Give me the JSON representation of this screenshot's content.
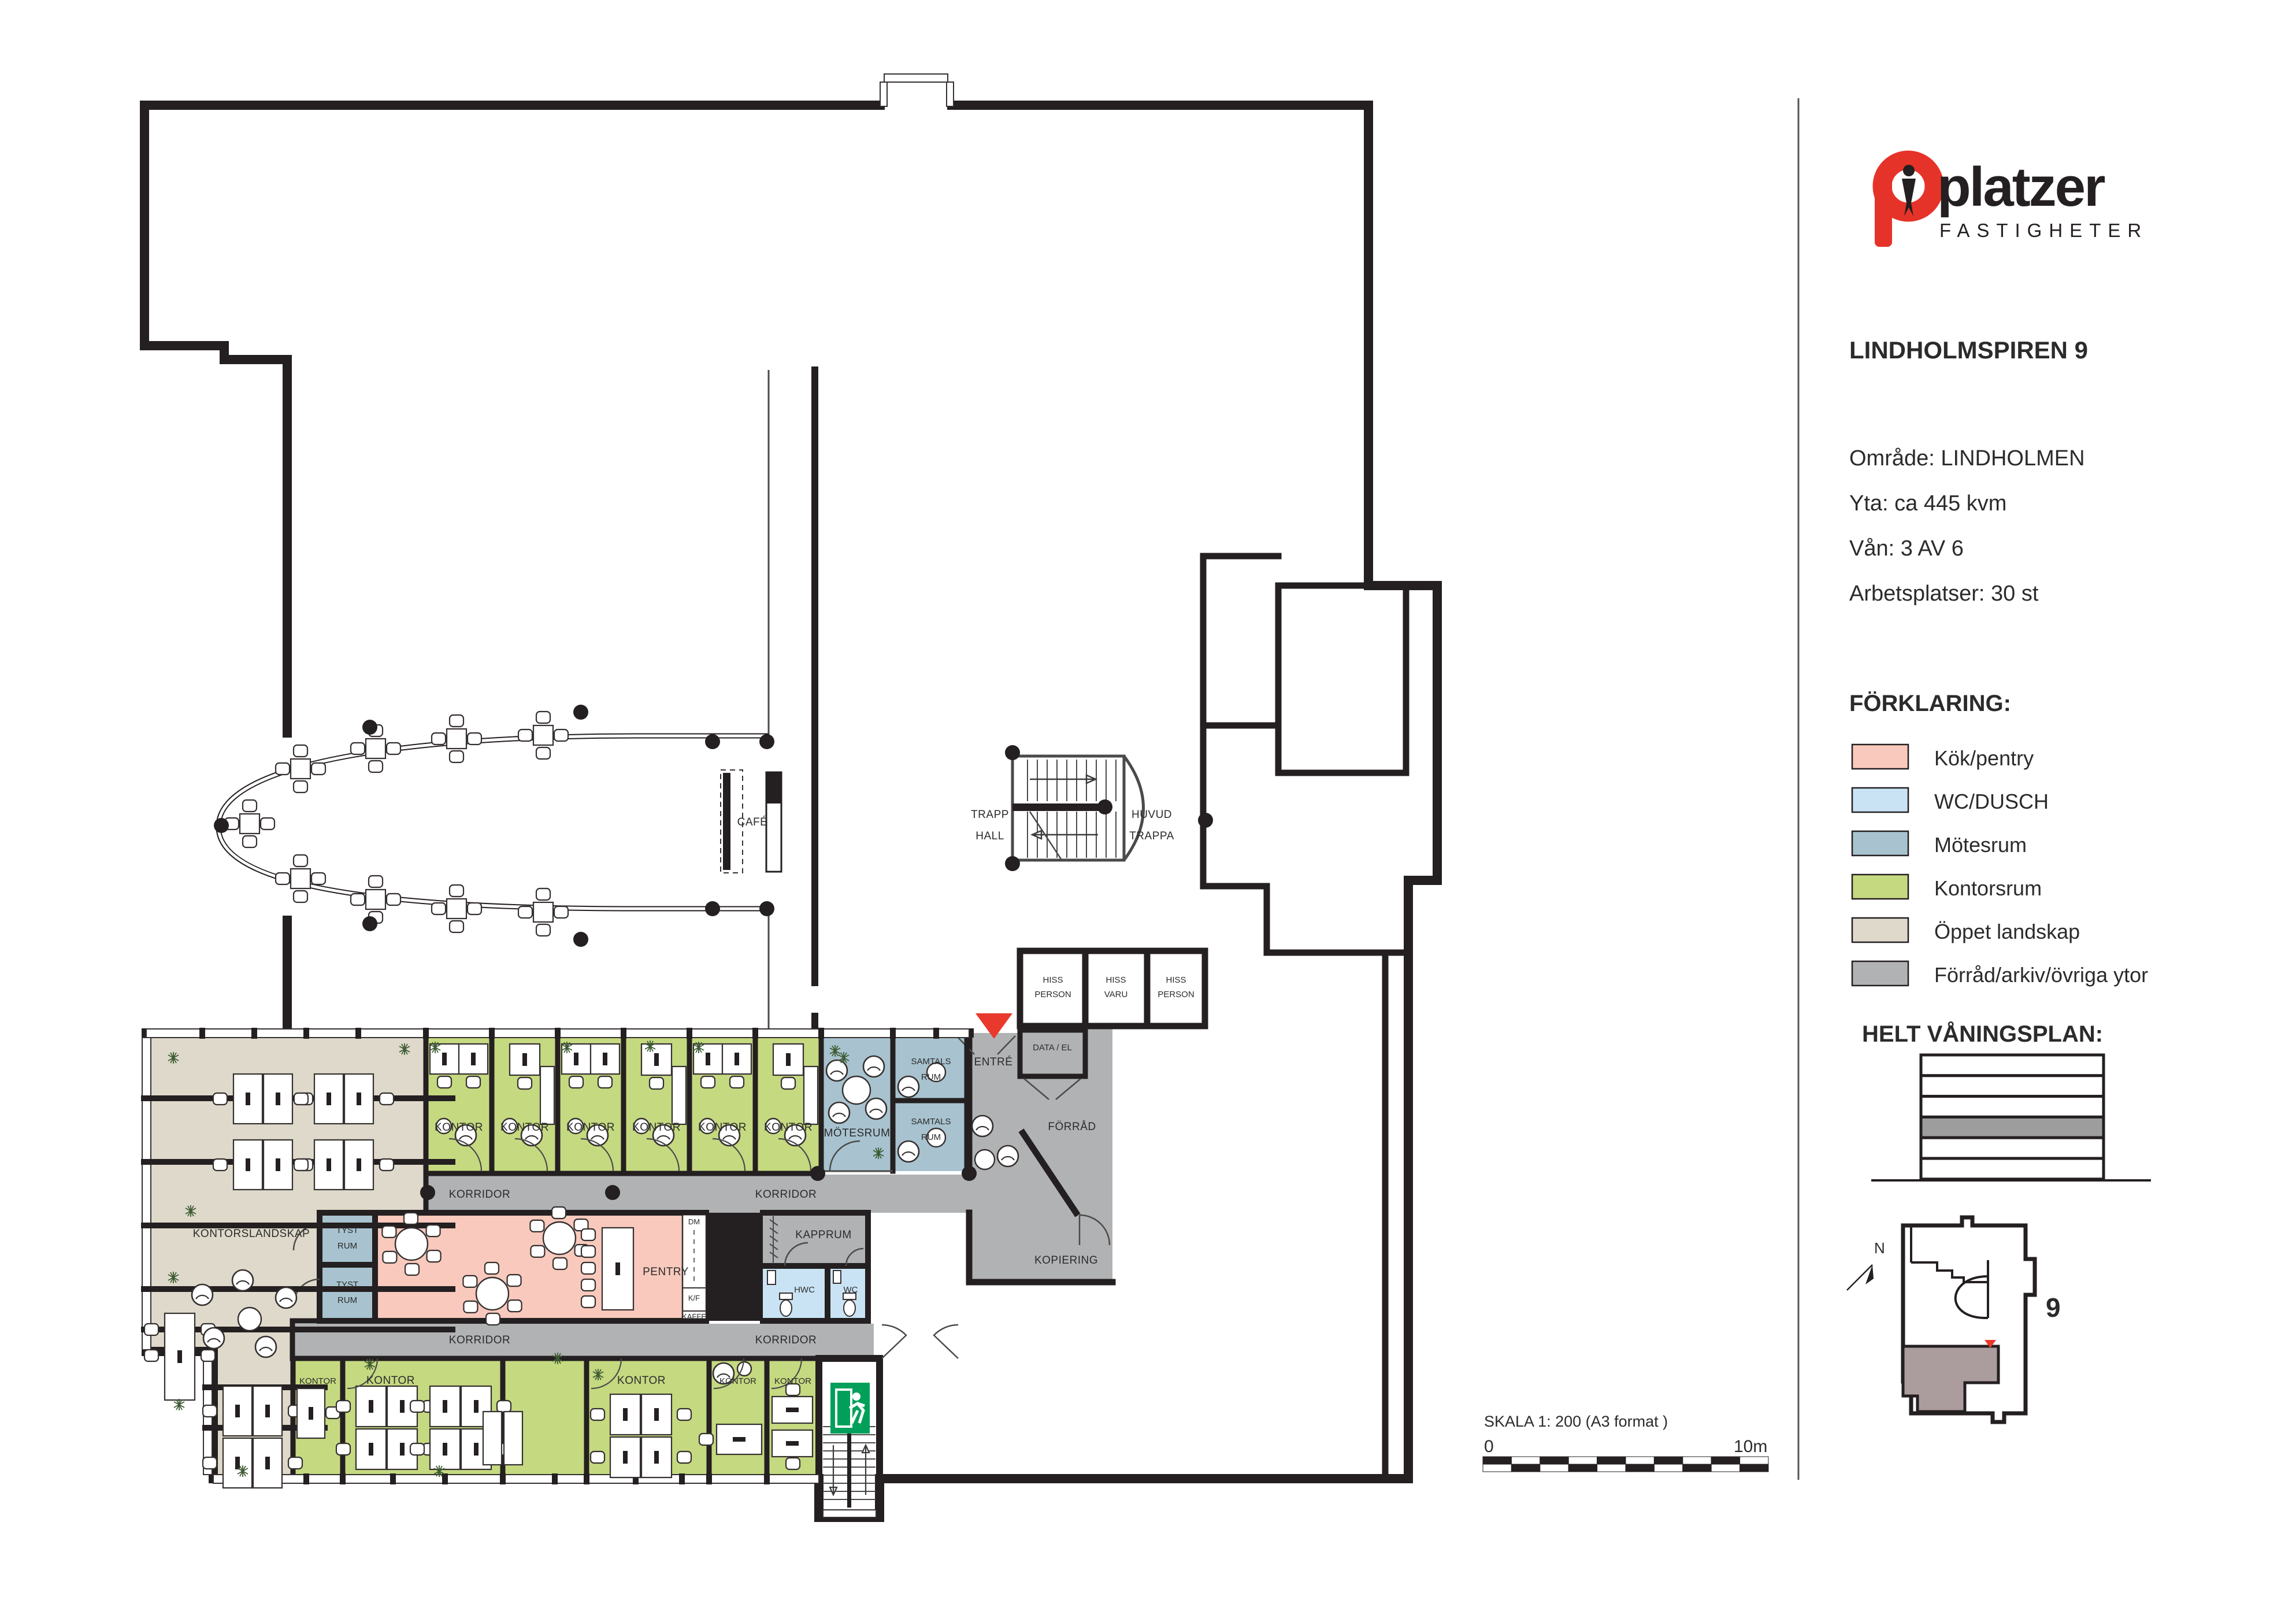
{
  "sidebar": {
    "logo": {
      "name": "platzer",
      "sub": "FASTIGHETER"
    },
    "title": "LINDHOLMSPIREN 9",
    "info": [
      "Område: LINDHOLMEN",
      "Yta: ca 445 kvm",
      "Vån: 3 AV 6",
      "Arbetsplatser: 30 st"
    ],
    "forklaring_title": "FÖRKLARING:",
    "legend": [
      {
        "label": "Kök/pentry",
        "color": "#f8c9bc"
      },
      {
        "label": "WC/DUSCH",
        "color": "#c9e3f4"
      },
      {
        "label": "Mötesrum",
        "color": "#a8c3cf"
      },
      {
        "label": "Kontorsrum",
        "color": "#c5d981"
      },
      {
        "label": "Öppet landskap",
        "color": "#ded9ca"
      },
      {
        "label": "Förråd/arkiv/övriga ytor",
        "color": "#b1b2b4"
      }
    ],
    "helt_vaningsplan_label": "HELT VÅNINGSPLAN:",
    "site": {
      "number": "9",
      "north": "N"
    }
  },
  "rooms": {
    "cafe": "CAFÉ",
    "trapp1": "TRAPP",
    "trapp2": "HALL",
    "huvud1": "HUVUD",
    "huvud2": "TRAPPA",
    "hiss": "HISS",
    "person": "PERSON",
    "varu": "VARU",
    "data_el": "DATA / EL",
    "entre": "ENTRÉ",
    "forrad": "FÖRRÅD",
    "kopiering": "KOPIERING",
    "samtals1": "SAMTALS",
    "samtals2": "RUM",
    "motesrum": "MÖTESRUM",
    "kontor": "KONTOR",
    "korridor": "KORRIDOR",
    "kontorslandskap": "KONTORSLANDSKAP",
    "tyst1": "TYST",
    "tyst2": "RUM",
    "pentry": "PENTRY",
    "dm": "DM",
    "kf": "K/F",
    "kaffe": "KAFFE",
    "kapprum": "KAPPRUM",
    "hwc": "HWC",
    "wc": "WC"
  },
  "scalebar": {
    "title": "SKALA 1: 200 (A3 format )",
    "start": "0",
    "end": "10m"
  },
  "colors": {
    "accent_red": "#e63329",
    "exit_green": "#00a05a",
    "highlight_mauve": "#ab9c9e",
    "floor_gray": "#9d9d9d"
  }
}
